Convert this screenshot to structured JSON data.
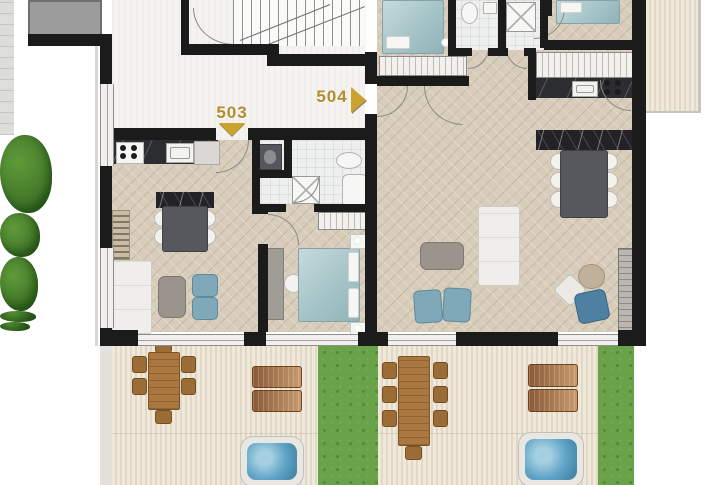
{
  "plan": {
    "name": "apartment-floor-plan",
    "units": [
      {
        "id": "unit-503",
        "label": "503",
        "marker": "triangle-down"
      },
      {
        "id": "unit-504",
        "label": "504",
        "marker": "triangle-right"
      }
    ]
  },
  "colors": {
    "wall": "#1b1b1b",
    "accent_gold": "#b18d2f",
    "accent_gold2": "#cda32f",
    "parquet": "#d8ccba",
    "hall_floor": "#f4f3f0",
    "bath_tile": "#eef0ef",
    "deck": "#ece4d5",
    "grass": "#6aa24a",
    "water": "#5fa3c6",
    "wood_furniture": "#a9773f",
    "bed_teal": "#a9c6ca",
    "pouf_blue": "#7fa9b8",
    "counter_dark": "#2c2d30",
    "neighbor_gray": "#9c9c9c"
  }
}
